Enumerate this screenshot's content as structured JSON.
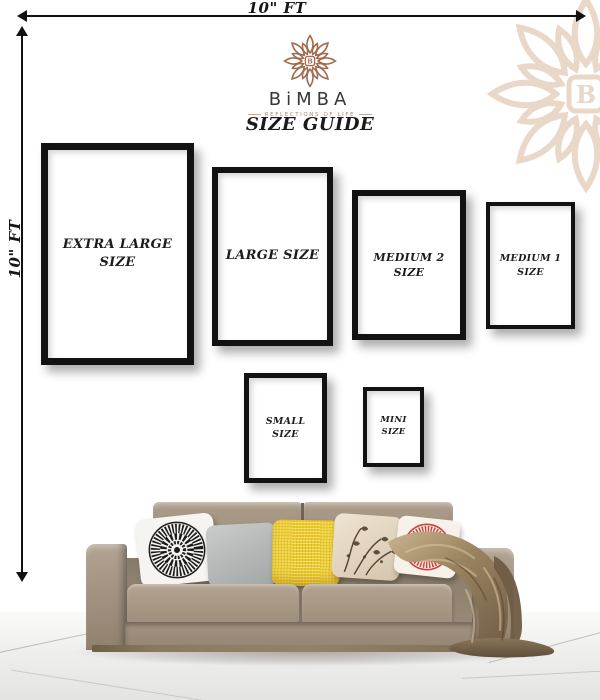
{
  "dimensions": {
    "top": {
      "label": "10\" FT"
    },
    "left": {
      "label": "10\" FT"
    }
  },
  "brand": {
    "logo_text": "BiMBA",
    "logo_letter": "B",
    "tagline": "REFLECTIONS OF LIFE",
    "title": "SIZE GUIDE",
    "logo_color": "#a06b4e",
    "watermark_color": "#e9d7c8",
    "wordmark_color": "#34383b",
    "tagline_color": "#b5816b"
  },
  "frames": [
    {
      "name": "extra-large",
      "label": "EXTRA LARGE SIZE",
      "lines": [
        "EXTRA LARGE",
        "SIZE"
      ]
    },
    {
      "name": "large",
      "label": "LARGE SIZE",
      "lines": [
        "LARGE SIZE"
      ]
    },
    {
      "name": "medium-2",
      "label": "MEDIUM 2 SIZE",
      "lines": [
        "MEDIUM 2",
        "SIZE"
      ]
    },
    {
      "name": "medium-1",
      "label": "MEDIUM 1 SIZE",
      "lines": [
        "MEDIUM 1",
        "SIZE"
      ]
    },
    {
      "name": "small",
      "label": "SMALL SIZE",
      "lines": [
        "SMALL",
        "SIZE"
      ]
    },
    {
      "name": "mini",
      "label": "MINI SIZE",
      "lines": [
        "MINI",
        "SIZE"
      ]
    }
  ],
  "scene": {
    "frame_border_color": "#121212",
    "sofa_color": "#a29382",
    "blanket_color": "#8d775a",
    "floor_color": "#ececeb",
    "pillows": [
      "black-white-mandala",
      "plain-gray",
      "yellow-textured",
      "cream-floral",
      "red-mandala"
    ],
    "pillow_colors": [
      "#1c1c1c",
      "#b4b9b8",
      "#efcd28",
      "#e8decb",
      "#cf3f38"
    ]
  }
}
